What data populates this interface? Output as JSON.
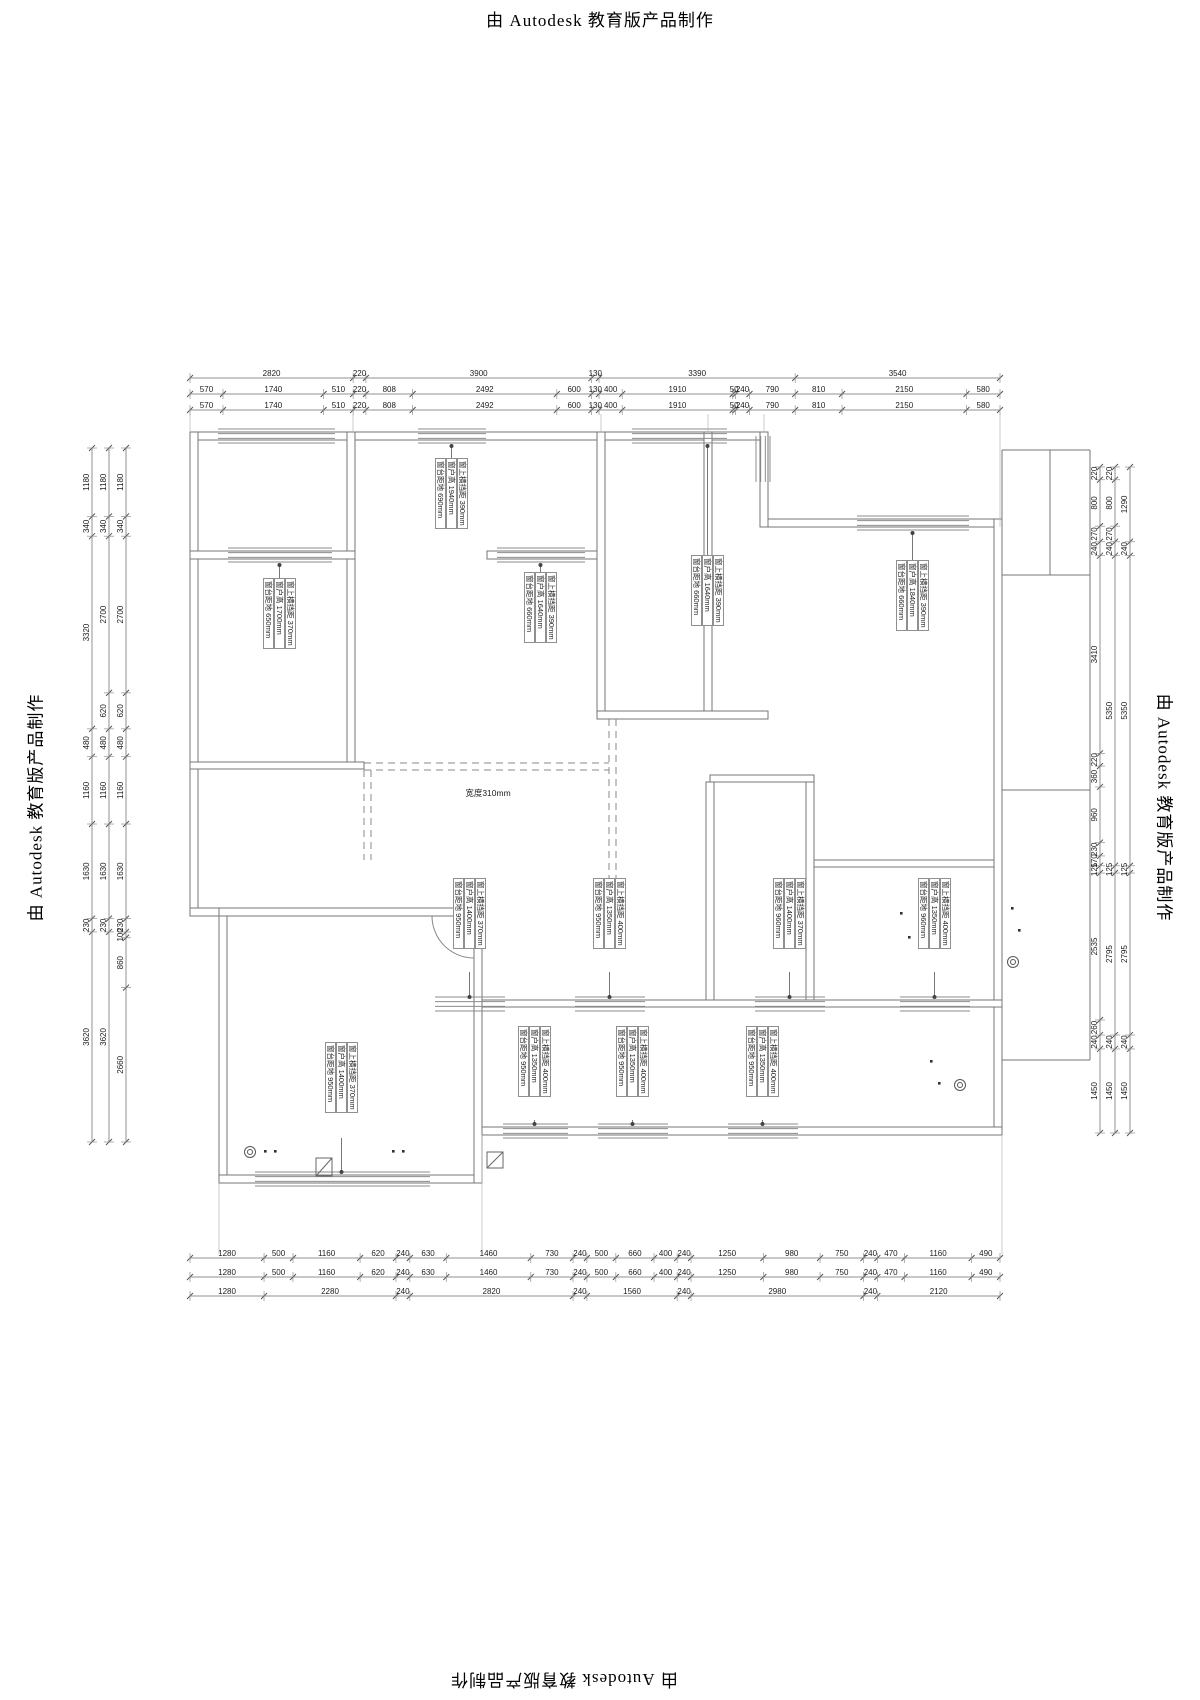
{
  "watermark": {
    "text": "由 Autodesk 教育版产品制作"
  },
  "opening_label": "宽度310mm",
  "colors": {
    "wall": "#767676",
    "window": "#8b8b8b",
    "dim_line": "#909090",
    "dim_text": "#1c1c1c"
  },
  "dimensions": {
    "top": [
      {
        "name": "row1",
        "values": [
          2820,
          220,
          3900,
          130,
          3390,
          3540
        ]
      },
      {
        "name": "row2",
        "values": [
          570,
          1740,
          510,
          220,
          808,
          2492,
          600,
          130,
          400,
          1910,
          50,
          240,
          790,
          810,
          2150,
          580
        ]
      },
      {
        "name": "row3",
        "values": [
          570,
          1740,
          510,
          220,
          808,
          2492,
          600,
          130,
          400,
          1910,
          50,
          240,
          790,
          810,
          2150,
          580
        ]
      }
    ],
    "bottom": [
      {
        "name": "row1",
        "values": [
          1280,
          500,
          1160,
          620,
          240,
          630,
          1460,
          730,
          240,
          500,
          660,
          400,
          240,
          1250,
          980,
          750,
          240,
          470,
          1160,
          490
        ]
      },
      {
        "name": "row2",
        "values": [
          1280,
          500,
          1160,
          620,
          240,
          630,
          1460,
          730,
          240,
          500,
          660,
          400,
          240,
          1250,
          980,
          750,
          240,
          470,
          1160,
          490
        ]
      },
      {
        "name": "row3",
        "values": [
          1280,
          2280,
          240,
          2820,
          240,
          1560,
          240,
          2980,
          240,
          2120
        ]
      }
    ],
    "left": [
      {
        "name": "outer",
        "values": [
          1180,
          340,
          3320,
          480,
          1160,
          1630,
          230,
          3620
        ]
      },
      {
        "name": "middle",
        "values": [
          1180,
          340,
          2700,
          620,
          480,
          1160,
          1630,
          230,
          3620
        ]
      },
      {
        "name": "inner",
        "values": [
          1180,
          340,
          2700,
          620,
          480,
          1160,
          1630,
          230,
          100,
          860,
          2660
        ]
      }
    ],
    "right": [
      {
        "name": "inner",
        "values": [
          220,
          800,
          270,
          240,
          3410,
          220,
          360,
          960,
          230,
          170,
          125,
          2535,
          260,
          240,
          1450
        ]
      },
      {
        "name": "middle",
        "values": [
          220,
          800,
          270,
          240,
          5350,
          125,
          2795,
          240,
          1450
        ]
      },
      {
        "name": "outer",
        "values": [
          1290,
          240,
          5350,
          125,
          2795,
          240,
          1450
        ]
      }
    ]
  },
  "window_labels": [
    {
      "beam": "窗上横挡距 370mm",
      "height": "窗户高 1700mm",
      "sill": "窗台距地 650mm"
    },
    {
      "beam": "窗上横挡距 390mm",
      "height": "窗户高 1940mm",
      "sill": "窗台距地 690mm"
    },
    {
      "beam": "窗上横挡距 390mm",
      "height": "窗户高 1640mm",
      "sill": "窗台距地 660mm"
    },
    {
      "beam": "窗上横挡距 390mm",
      "height": "窗户高 1640mm",
      "sill": "窗台距地 660mm"
    },
    {
      "beam": "窗上横挡距 390mm",
      "height": "窗户高 1840mm",
      "sill": "窗台距地 660mm"
    },
    {
      "beam": "窗上横挡距 370mm",
      "height": "窗户高 1400mm",
      "sill": "窗台距地 950mm"
    },
    {
      "beam": "窗上横挡距 400mm",
      "height": "窗户高 1350mm",
      "sill": "窗台距地 950mm"
    },
    {
      "beam": "窗上横挡距 370mm",
      "height": "窗户高 1400mm",
      "sill": "窗台距地 960mm"
    },
    {
      "beam": "窗上横挡距 400mm",
      "height": "窗户高 1350mm",
      "sill": "窗台距地 960mm"
    },
    {
      "beam": "窗上横挡距 370mm",
      "height": "窗户高 1400mm",
      "sill": "窗台距地 950mm"
    },
    {
      "beam": "窗上横挡距 400mm",
      "height": "窗户高 1350mm",
      "sill": "窗台距地 950mm"
    },
    {
      "beam": "窗上横挡距 400mm",
      "height": "窗户高 1350mm",
      "sill": "窗台距地 950mm"
    },
    {
      "beam": "窗上横挡距 400mm",
      "height": "窗户高 1350mm",
      "sill": "窗台距地 950mm"
    }
  ]
}
